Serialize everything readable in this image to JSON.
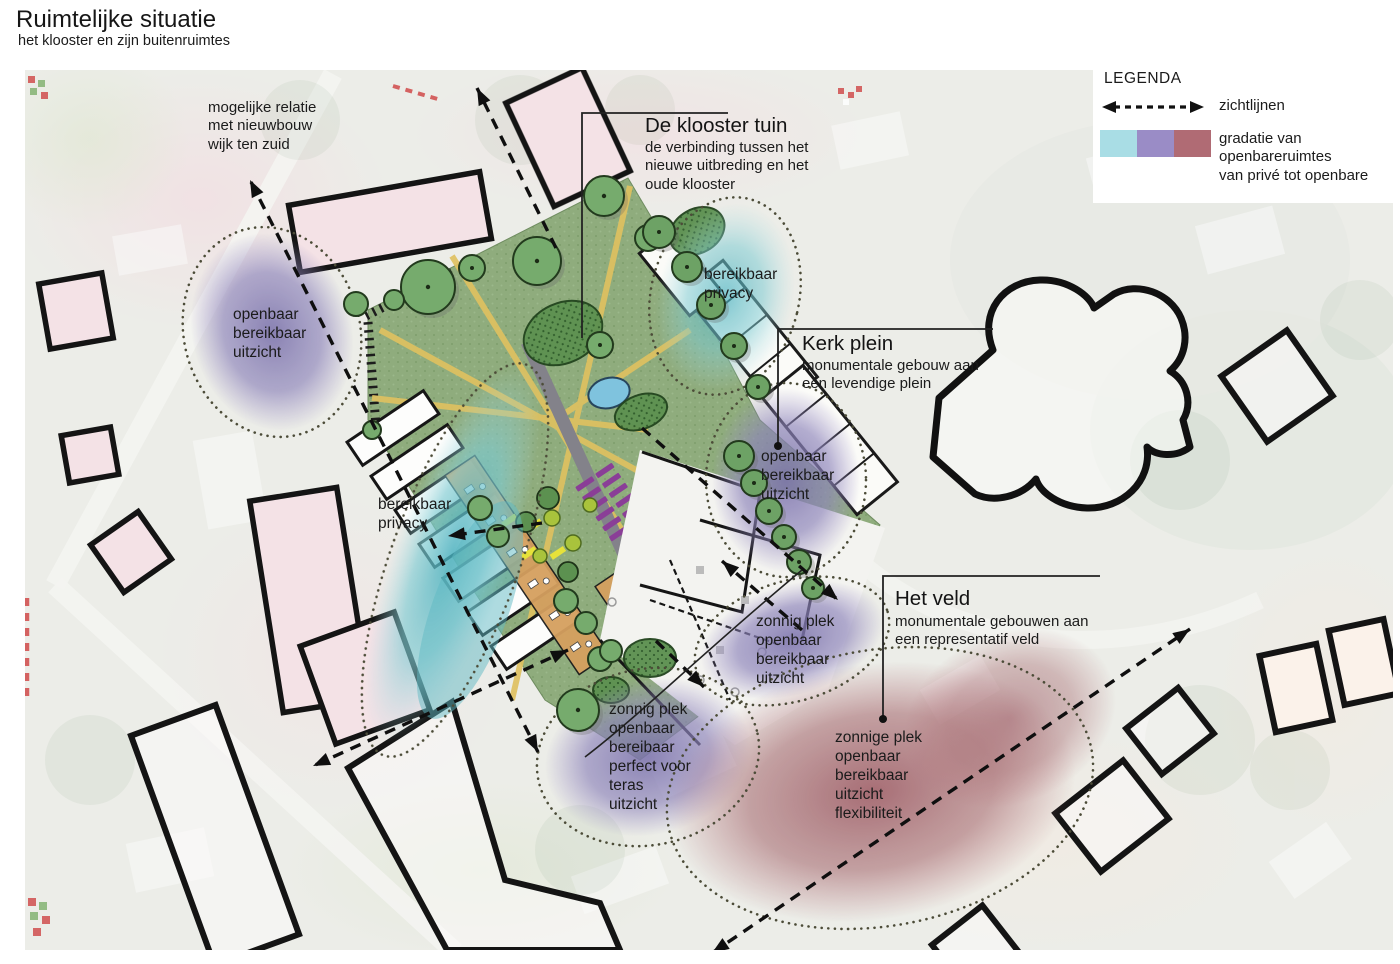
{
  "header": {
    "title": "Ruimtelijke situatie",
    "subtitle": "het klooster en zijn buitenruimtes"
  },
  "legend": {
    "heading": "LEGENDA",
    "sightlines_label": "zichtlijnen",
    "gradient_label": "gradatie van\nopenbareruimtes\nvan privé tot openbare",
    "swatch_colors": [
      "#a9dde5",
      "#9a8cc6",
      "#b06b74"
    ]
  },
  "callouts": {
    "relation_note": "mogelijke relatie\nmet nieuwbouw\nwijk ten zuid",
    "klooster_tuin_title": "De klooster tuin",
    "klooster_tuin_sub": "de verbinding tussen het\nnieuwe uitbreding en het\noude klooster",
    "kerk_plein_title": "Kerk plein",
    "kerk_plein_sub": "monumentale gebouw aan\neen levendige plein",
    "het_veld_title": "Het veld",
    "het_veld_sub": "monumentale gebouwen aan\neen representatif veld"
  },
  "zones": [
    {
      "id": "openbaar-west",
      "text": "openbaar\nbereikbaar\nuitzicht"
    },
    {
      "id": "bereikbaar-noord",
      "text": "bereikbaar\nprivacy"
    },
    {
      "id": "bereikbaar-west",
      "text": "bereikbaar\nprivacy"
    },
    {
      "id": "openbaar-plein",
      "text": "openbaar\nbereikbaar\nuitzicht"
    },
    {
      "id": "zonnig-plein",
      "text": "zonnig plek\nopenbaar\nbereikbaar\nuitzicht"
    },
    {
      "id": "zonnig-teras",
      "text": "zonnig plek\nopenbaar\nbereibaar\nperfect voor\nteras\nuitzicht"
    },
    {
      "id": "zonnige-veld",
      "text": "zonnige plek\nopenbaar\nbereikbaar\nuitzicht\nflexibiliteit"
    }
  ],
  "map_colors": {
    "garden_green": "#8fac7d",
    "zone_private_cyan": "#46aebc",
    "zone_semi_purple": "#7b72ab",
    "zone_public_red": "#99545e",
    "building_pink": "#f4e2e6",
    "path_yellow": "#dfc160",
    "tree_green": "#76ab6d",
    "pond_blue": "#7fc3de"
  }
}
